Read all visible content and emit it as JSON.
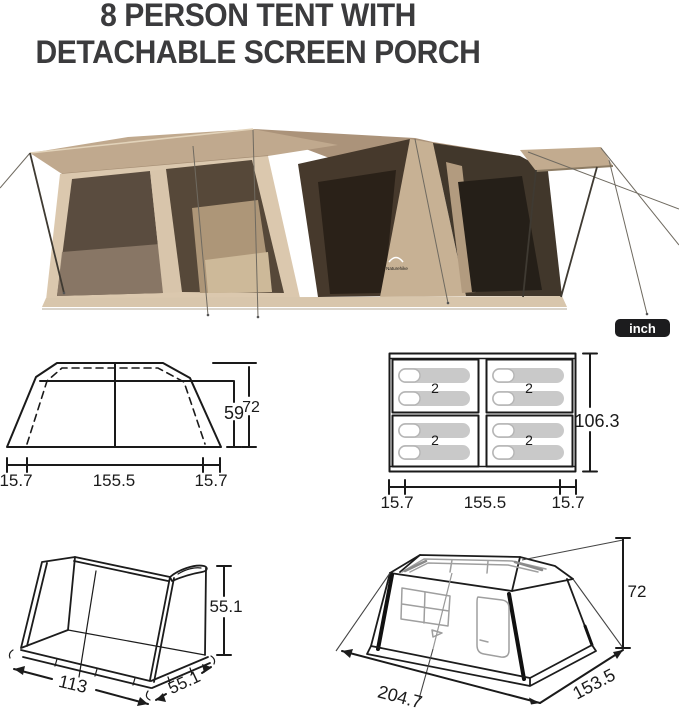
{
  "title": {
    "line1": "8 PERSON TENT WITH",
    "line2": "DETACHABLE SCREEN PORCH"
  },
  "unit_badge": {
    "label": "inch"
  },
  "photo": {
    "brand_logo": "Naturehike"
  },
  "colors": {
    "title_text": "#3b3b3d",
    "badge_bg": "#1c1c1e",
    "badge_fg": "#ffffff",
    "diagram_line": "#1a1a1a",
    "sleeping_pad": "#c9c9c9",
    "tent_fabric_tan": "#c0a98e",
    "tent_window_tint": "#564839",
    "porch_fabric_dark": "#41372b"
  },
  "diagrams": {
    "front_view": {
      "inner_height": "59",
      "outer_height": "72",
      "left_ext": "15.7",
      "width": "155.5",
      "right_ext": "15.7"
    },
    "floor_plan": {
      "depth": "106.3",
      "left_ext": "15.7",
      "width": "155.5",
      "right_ext": "15.7",
      "quadrant_capacities": [
        "2",
        "2",
        "2",
        "2"
      ]
    },
    "porch_view": {
      "height": "55.1",
      "width": "113",
      "depth": "55.1"
    },
    "perspective_view": {
      "height": "72",
      "width": "204.7",
      "depth": "153.5"
    }
  }
}
